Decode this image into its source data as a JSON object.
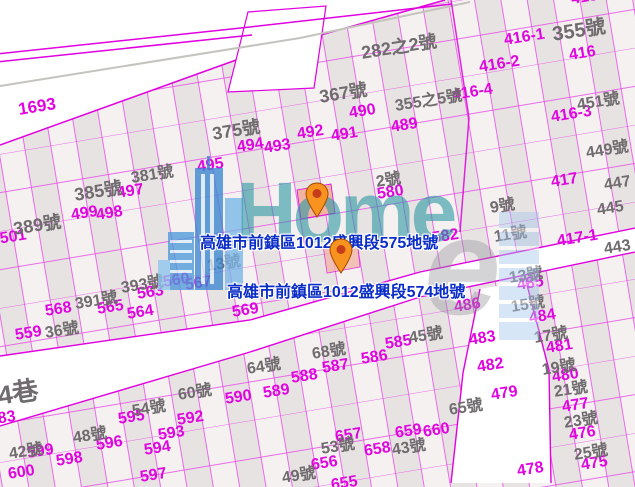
{
  "page": {
    "width": 635,
    "height": 487
  },
  "colors": {
    "parcel_line": "#e235e2",
    "parcel_text": "#e006e0",
    "house_text": "#6f6b6e",
    "road_fill": "#ffffff",
    "selected_fill": "#f1b3a2",
    "address_text": "#0a2cc7",
    "watermark_teal": "#2b97a3",
    "building_blue": "#3b87d3",
    "marker_orange": "#f7931e"
  },
  "watermark": {
    "brand": "Home",
    "swirl_letter": "e"
  },
  "selected_parcels": [
    {
      "label": "高雄市前鎮區1012盛興段575地號"
    },
    {
      "label": "高雄市前鎮區1012盛興段574地號"
    }
  ],
  "markers": [
    {
      "x": 317,
      "y": 217
    },
    {
      "x": 341,
      "y": 273
    }
  ],
  "map": {
    "parcel_numbers": [
      {
        "t": "1693",
        "x": 17,
        "y": 101,
        "s": 17
      },
      {
        "t": "2501",
        "x": -10,
        "y": 233
      },
      {
        "t": "495",
        "x": 196,
        "y": 160
      },
      {
        "t": "494",
        "x": 236,
        "y": 140
      },
      {
        "t": "493",
        "x": 263,
        "y": 141
      },
      {
        "t": "497",
        "x": 116,
        "y": 186
      },
      {
        "t": "499",
        "x": 70,
        "y": 208
      },
      {
        "t": "498",
        "x": 95,
        "y": 208
      },
      {
        "t": "492",
        "x": 296,
        "y": 127
      },
      {
        "t": "491",
        "x": 330,
        "y": 129
      },
      {
        "t": "490",
        "x": 348,
        "y": 106
      },
      {
        "t": "489",
        "x": 390,
        "y": 120
      },
      {
        "t": "415",
        "x": 570,
        "y": -8
      },
      {
        "t": "416-1",
        "x": 503,
        "y": 33
      },
      {
        "t": "416",
        "x": 568,
        "y": 48
      },
      {
        "t": "416-2",
        "x": 478,
        "y": 60
      },
      {
        "t": "416-4",
        "x": 451,
        "y": 88
      },
      {
        "t": "416-3",
        "x": 550,
        "y": 110
      },
      {
        "t": "417",
        "x": 550,
        "y": 175
      },
      {
        "t": "417-1",
        "x": 556,
        "y": 234
      },
      {
        "t": "582",
        "x": 431,
        "y": 231
      },
      {
        "t": "580",
        "x": 376,
        "y": 187
      },
      {
        "t": "560",
        "x": 162,
        "y": 275
      },
      {
        "t": "567",
        "x": 184,
        "y": 278
      },
      {
        "t": "569",
        "x": 231,
        "y": 305
      },
      {
        "t": "568",
        "x": 44,
        "y": 304
      },
      {
        "t": "565",
        "x": 96,
        "y": 302
      },
      {
        "t": "564",
        "x": 126,
        "y": 307
      },
      {
        "t": "563",
        "x": 136,
        "y": 287
      },
      {
        "t": "559",
        "x": 14,
        "y": 328
      },
      {
        "t": "583",
        "x": -12,
        "y": 413
      },
      {
        "t": "600",
        "x": 7,
        "y": 467
      },
      {
        "t": "599",
        "x": 26,
        "y": 446
      },
      {
        "t": "598",
        "x": 55,
        "y": 454
      },
      {
        "t": "597",
        "x": 139,
        "y": 470
      },
      {
        "t": "596",
        "x": 95,
        "y": 438
      },
      {
        "t": "595",
        "x": 117,
        "y": 412
      },
      {
        "t": "594",
        "x": 143,
        "y": 443
      },
      {
        "t": "593",
        "x": 157,
        "y": 428
      },
      {
        "t": "592",
        "x": 176,
        "y": 413
      },
      {
        "t": "590",
        "x": 224,
        "y": 392
      },
      {
        "t": "589",
        "x": 262,
        "y": 386
      },
      {
        "t": "588",
        "x": 290,
        "y": 371
      },
      {
        "t": "587",
        "x": 321,
        "y": 361
      },
      {
        "t": "586",
        "x": 360,
        "y": 352
      },
      {
        "t": "585",
        "x": 384,
        "y": 337
      },
      {
        "t": "657",
        "x": 334,
        "y": 430
      },
      {
        "t": "658",
        "x": 363,
        "y": 444
      },
      {
        "t": "659",
        "x": 394,
        "y": 426
      },
      {
        "t": "660",
        "x": 422,
        "y": 425
      },
      {
        "t": "656",
        "x": 310,
        "y": 458
      },
      {
        "t": "655",
        "x": 330,
        "y": 478
      },
      {
        "t": "486",
        "x": 453,
        "y": 300
      },
      {
        "t": "485",
        "x": 516,
        "y": 278
      },
      {
        "t": "484",
        "x": 528,
        "y": 311
      },
      {
        "t": "483",
        "x": 468,
        "y": 333
      },
      {
        "t": "482",
        "x": 476,
        "y": 360
      },
      {
        "t": "481",
        "x": 545,
        "y": 341
      },
      {
        "t": "480",
        "x": 551,
        "y": 370
      },
      {
        "t": "479",
        "x": 490,
        "y": 388
      },
      {
        "t": "478",
        "x": 516,
        "y": 464
      },
      {
        "t": "477",
        "x": 561,
        "y": 400
      },
      {
        "t": "476",
        "x": 568,
        "y": 428
      },
      {
        "t": "475",
        "x": 580,
        "y": 458
      }
    ],
    "house_numbers": [
      {
        "t": "282之2號",
        "x": 360,
        "y": 44,
        "s": 18
      },
      {
        "t": "355號",
        "x": 551,
        "y": 25,
        "s": 20
      },
      {
        "t": "367號",
        "x": 318,
        "y": 88,
        "s": 18
      },
      {
        "t": "375號",
        "x": 211,
        "y": 125,
        "s": 18
      },
      {
        "t": "355之5號",
        "x": 394,
        "y": 99
      },
      {
        "t": "451號",
        "x": 576,
        "y": 98
      },
      {
        "t": "449號",
        "x": 585,
        "y": 146
      },
      {
        "t": "447",
        "x": 603,
        "y": 178
      },
      {
        "t": "445",
        "x": 596,
        "y": 203
      },
      {
        "t": "443",
        "x": 603,
        "y": 242
      },
      {
        "t": "385號",
        "x": 73,
        "y": 186,
        "s": 18
      },
      {
        "t": "381號",
        "x": 130,
        "y": 171
      },
      {
        "t": "389號",
        "x": 12,
        "y": 220,
        "s": 18
      },
      {
        "t": "393號",
        "x": 120,
        "y": 281
      },
      {
        "t": "391號",
        "x": 74,
        "y": 297
      },
      {
        "t": "2號",
        "x": 375,
        "y": 175
      },
      {
        "t": "9號",
        "x": 489,
        "y": 201
      },
      {
        "t": "11號",
        "x": 493,
        "y": 230
      },
      {
        "t": "13號",
        "x": 508,
        "y": 271
      },
      {
        "t": "15號",
        "x": 510,
        "y": 300
      },
      {
        "t": "17號",
        "x": 533,
        "y": 331
      },
      {
        "t": "19號",
        "x": 541,
        "y": 363
      },
      {
        "t": "21號",
        "x": 553,
        "y": 385
      },
      {
        "t": "23號",
        "x": 563,
        "y": 416
      },
      {
        "t": "25號",
        "x": 573,
        "y": 448
      },
      {
        "t": "45號",
        "x": 408,
        "y": 331
      },
      {
        "t": "65號",
        "x": 448,
        "y": 403
      },
      {
        "t": "43號",
        "x": 391,
        "y": 443
      },
      {
        "t": "13號",
        "x": 206,
        "y": 259
      },
      {
        "t": "53號",
        "x": 320,
        "y": 442
      },
      {
        "t": "49號",
        "x": 281,
        "y": 471
      },
      {
        "t": "36號",
        "x": 44,
        "y": 326
      },
      {
        "t": "54號",
        "x": 131,
        "y": 404
      },
      {
        "t": "60號",
        "x": 177,
        "y": 388
      },
      {
        "t": "64號",
        "x": 246,
        "y": 362
      },
      {
        "t": "68號",
        "x": 311,
        "y": 347
      },
      {
        "t": "48號",
        "x": 72,
        "y": 431
      },
      {
        "t": "42號",
        "x": 8,
        "y": 447
      },
      {
        "t": "4巷",
        "x": -4,
        "y": 383,
        "s": 26
      }
    ]
  }
}
